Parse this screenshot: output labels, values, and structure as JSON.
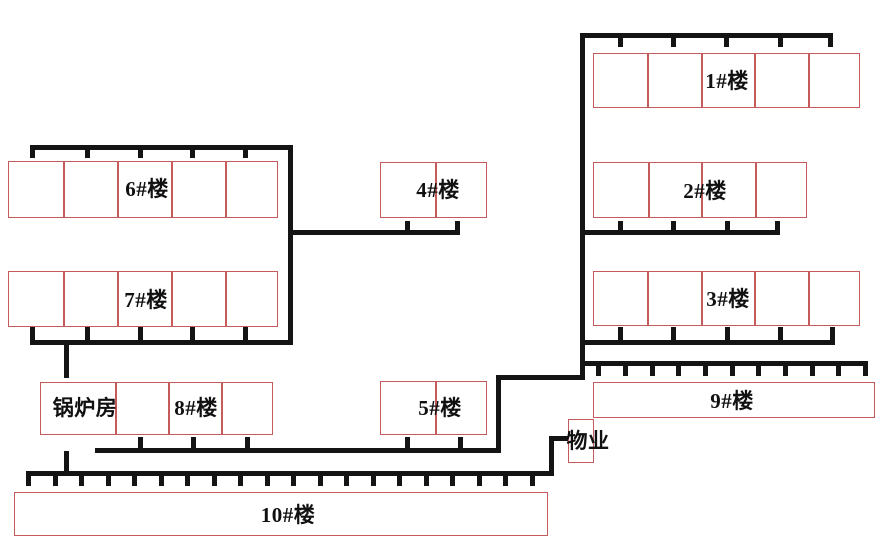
{
  "diagram": {
    "kind": "site-plan-heating-network",
    "width": 884,
    "height": 543
  },
  "colors": {
    "pipe": "#141414",
    "building_outline": "#c65b5b",
    "text": "#111111",
    "background": "#ffffff"
  },
  "buildings": [
    {
      "id": "building-6",
      "x": 8,
      "y": 161,
      "w": 270,
      "h": 57,
      "cells": 5,
      "labels": [
        {
          "text": "6#楼",
          "cx": 147,
          "cy": 188
        }
      ]
    },
    {
      "id": "building-7",
      "x": 8,
      "y": 271,
      "w": 270,
      "h": 56,
      "cells": 5,
      "labels": [
        {
          "text": "7#楼",
          "cx": 146,
          "cy": 299
        }
      ]
    },
    {
      "id": "building-4",
      "x": 380,
      "y": 162,
      "w": 107,
      "h": 56,
      "cells": 2,
      "labels": [
        {
          "text": "4#楼",
          "cx": 438,
          "cy": 189
        }
      ]
    },
    {
      "id": "building-5",
      "x": 380,
      "y": 381,
      "w": 107,
      "h": 54,
      "cells": 2,
      "labels": [
        {
          "text": "5#楼",
          "cx": 440,
          "cy": 407
        }
      ]
    },
    {
      "id": "building-1",
      "x": 593,
      "y": 53,
      "w": 267,
      "h": 55,
      "cells": 5,
      "labels": [
        {
          "text": "1#楼",
          "cx": 727,
          "cy": 80
        }
      ]
    },
    {
      "id": "building-2",
      "x": 593,
      "y": 162,
      "w": 214,
      "h": 56,
      "cells": 4,
      "labels": [
        {
          "text": "2#楼",
          "cx": 705,
          "cy": 190
        }
      ]
    },
    {
      "id": "building-3",
      "x": 593,
      "y": 271,
      "w": 267,
      "h": 55,
      "cells": 5,
      "labels": [
        {
          "text": "3#楼",
          "cx": 728,
          "cy": 298
        }
      ]
    },
    {
      "id": "building-9",
      "x": 593,
      "y": 382,
      "w": 282,
      "h": 36,
      "cells": 1,
      "labels": [
        {
          "text": "9#楼",
          "cx": 732,
          "cy": 400
        }
      ]
    },
    {
      "id": "building-boiler-8",
      "x": 40,
      "y": 382,
      "w": 233,
      "h": 53,
      "dividers": [
        74,
        127,
        180
      ],
      "labels": [
        {
          "text": "锅炉房",
          "cx": 85,
          "cy": 407
        },
        {
          "text": "8#楼",
          "cx": 196,
          "cy": 407
        }
      ]
    },
    {
      "id": "building-wuye",
      "x": 568,
      "y": 419,
      "w": 26,
      "h": 44,
      "cells": 1,
      "labels": [
        {
          "text": "物业",
          "cx": 588,
          "cy": 440
        }
      ]
    },
    {
      "id": "building-10",
      "x": 14,
      "y": 492,
      "w": 534,
      "h": 44,
      "cells": 1,
      "labels": [
        {
          "text": "10#楼",
          "cx": 288,
          "cy": 514
        }
      ]
    }
  ],
  "pipes": [
    {
      "x": 30,
      "y": 145,
      "w": 263,
      "h": 5
    },
    {
      "x": 30,
      "y": 150,
      "w": 5,
      "h": 8
    },
    {
      "x": 85,
      "y": 150,
      "w": 5,
      "h": 8
    },
    {
      "x": 138,
      "y": 150,
      "w": 5,
      "h": 8
    },
    {
      "x": 190,
      "y": 150,
      "w": 5,
      "h": 8
    },
    {
      "x": 243,
      "y": 150,
      "w": 5,
      "h": 8
    },
    {
      "x": 288,
      "y": 145,
      "w": 5,
      "h": 200
    },
    {
      "x": 30,
      "y": 340,
      "w": 263,
      "h": 5
    },
    {
      "x": 30,
      "y": 327,
      "w": 5,
      "h": 13
    },
    {
      "x": 85,
      "y": 327,
      "w": 5,
      "h": 13
    },
    {
      "x": 138,
      "y": 327,
      "w": 5,
      "h": 13
    },
    {
      "x": 190,
      "y": 327,
      "w": 5,
      "h": 13
    },
    {
      "x": 243,
      "y": 327,
      "w": 5,
      "h": 13
    },
    {
      "x": 64,
      "y": 345,
      "w": 5,
      "h": 33
    },
    {
      "x": 288,
      "y": 230,
      "w": 172,
      "h": 5
    },
    {
      "x": 405,
      "y": 221,
      "w": 5,
      "h": 9
    },
    {
      "x": 455,
      "y": 221,
      "w": 5,
      "h": 14
    },
    {
      "x": 580,
      "y": 33,
      "w": 5,
      "h": 347
    },
    {
      "x": 580,
      "y": 33,
      "w": 253,
      "h": 5
    },
    {
      "x": 828,
      "y": 38,
      "w": 5,
      "h": 9
    },
    {
      "x": 618,
      "y": 38,
      "w": 5,
      "h": 9
    },
    {
      "x": 671,
      "y": 38,
      "w": 5,
      "h": 9
    },
    {
      "x": 724,
      "y": 38,
      "w": 5,
      "h": 9
    },
    {
      "x": 778,
      "y": 38,
      "w": 5,
      "h": 9
    },
    {
      "x": 580,
      "y": 230,
      "w": 200,
      "h": 5
    },
    {
      "x": 775,
      "y": 221,
      "w": 5,
      "h": 14
    },
    {
      "x": 618,
      "y": 221,
      "w": 5,
      "h": 9
    },
    {
      "x": 671,
      "y": 221,
      "w": 5,
      "h": 9
    },
    {
      "x": 725,
      "y": 221,
      "w": 5,
      "h": 9
    },
    {
      "x": 580,
      "y": 340,
      "w": 255,
      "h": 5
    },
    {
      "x": 830,
      "y": 327,
      "w": 5,
      "h": 18
    },
    {
      "x": 618,
      "y": 327,
      "w": 5,
      "h": 13
    },
    {
      "x": 671,
      "y": 327,
      "w": 5,
      "h": 13
    },
    {
      "x": 725,
      "y": 327,
      "w": 5,
      "h": 13
    },
    {
      "x": 778,
      "y": 327,
      "w": 5,
      "h": 13
    },
    {
      "x": 580,
      "y": 361,
      "w": 288,
      "h": 5
    },
    {
      "x": 863,
      "y": 366,
      "w": 5,
      "h": 10
    },
    {
      "x": 596,
      "y": 366,
      "w": 5,
      "h": 10
    },
    {
      "x": 623,
      "y": 366,
      "w": 5,
      "h": 10
    },
    {
      "x": 650,
      "y": 366,
      "w": 5,
      "h": 10
    },
    {
      "x": 676,
      "y": 366,
      "w": 5,
      "h": 10
    },
    {
      "x": 703,
      "y": 366,
      "w": 5,
      "h": 10
    },
    {
      "x": 730,
      "y": 366,
      "w": 5,
      "h": 10
    },
    {
      "x": 756,
      "y": 366,
      "w": 5,
      "h": 10
    },
    {
      "x": 783,
      "y": 366,
      "w": 5,
      "h": 10
    },
    {
      "x": 810,
      "y": 366,
      "w": 5,
      "h": 10
    },
    {
      "x": 836,
      "y": 366,
      "w": 5,
      "h": 10
    },
    {
      "x": 496,
      "y": 375,
      "w": 89,
      "h": 5
    },
    {
      "x": 496,
      "y": 375,
      "w": 5,
      "h": 77
    },
    {
      "x": 95,
      "y": 448,
      "w": 406,
      "h": 5
    },
    {
      "x": 138,
      "y": 437,
      "w": 5,
      "h": 11
    },
    {
      "x": 191,
      "y": 437,
      "w": 5,
      "h": 11
    },
    {
      "x": 245,
      "y": 437,
      "w": 5,
      "h": 11
    },
    {
      "x": 405,
      "y": 437,
      "w": 5,
      "h": 11
    },
    {
      "x": 458,
      "y": 437,
      "w": 5,
      "h": 11
    },
    {
      "x": 64,
      "y": 451,
      "w": 5,
      "h": 25
    },
    {
      "x": 26,
      "y": 471,
      "w": 528,
      "h": 5
    },
    {
      "x": 26,
      "y": 476,
      "w": 5,
      "h": 10
    },
    {
      "x": 53,
      "y": 476,
      "w": 5,
      "h": 10
    },
    {
      "x": 79,
      "y": 476,
      "w": 5,
      "h": 10
    },
    {
      "x": 106,
      "y": 476,
      "w": 5,
      "h": 10
    },
    {
      "x": 132,
      "y": 476,
      "w": 5,
      "h": 10
    },
    {
      "x": 159,
      "y": 476,
      "w": 5,
      "h": 10
    },
    {
      "x": 185,
      "y": 476,
      "w": 5,
      "h": 10
    },
    {
      "x": 212,
      "y": 476,
      "w": 5,
      "h": 10
    },
    {
      "x": 238,
      "y": 476,
      "w": 5,
      "h": 10
    },
    {
      "x": 265,
      "y": 476,
      "w": 5,
      "h": 10
    },
    {
      "x": 291,
      "y": 476,
      "w": 5,
      "h": 10
    },
    {
      "x": 318,
      "y": 476,
      "w": 5,
      "h": 10
    },
    {
      "x": 344,
      "y": 476,
      "w": 5,
      "h": 10
    },
    {
      "x": 371,
      "y": 476,
      "w": 5,
      "h": 10
    },
    {
      "x": 397,
      "y": 476,
      "w": 5,
      "h": 10
    },
    {
      "x": 424,
      "y": 476,
      "w": 5,
      "h": 10
    },
    {
      "x": 450,
      "y": 476,
      "w": 5,
      "h": 10
    },
    {
      "x": 477,
      "y": 476,
      "w": 5,
      "h": 10
    },
    {
      "x": 503,
      "y": 476,
      "w": 5,
      "h": 10
    },
    {
      "x": 530,
      "y": 476,
      "w": 5,
      "h": 10
    },
    {
      "x": 549,
      "y": 436,
      "w": 5,
      "h": 40
    },
    {
      "x": 549,
      "y": 436,
      "w": 20,
      "h": 5
    }
  ]
}
